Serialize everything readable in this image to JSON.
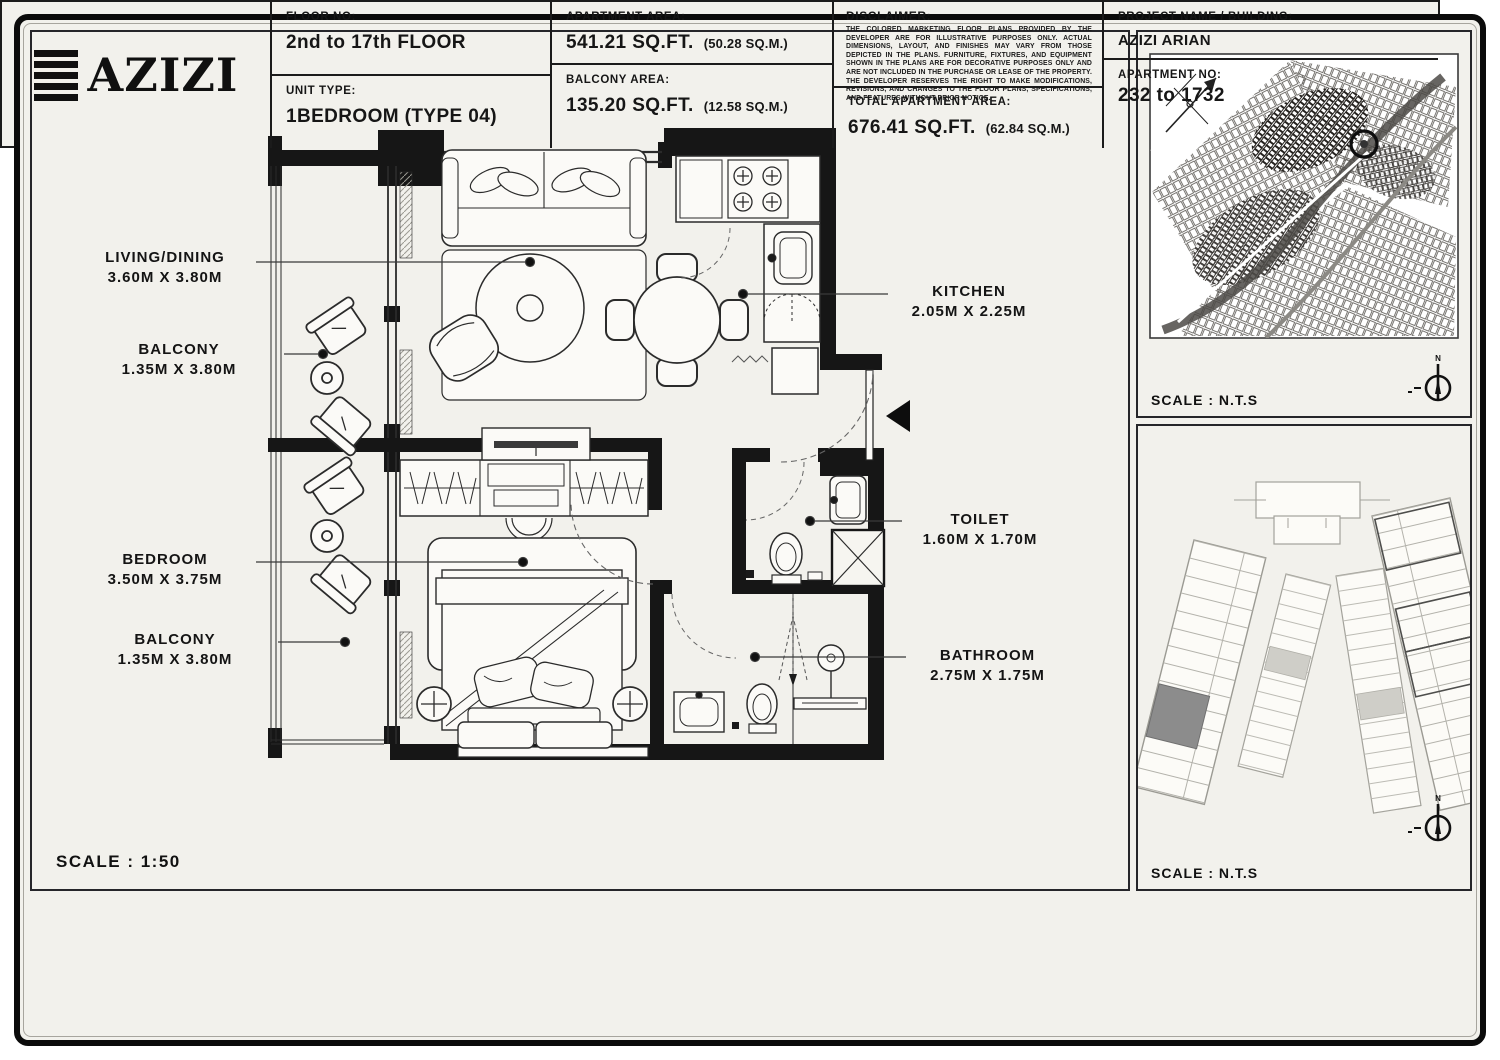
{
  "colors": {
    "paper": "#f2f1ec",
    "line": "#141414",
    "wall": "#161616",
    "furniture_fill": "#fbfaf7",
    "highlight_unit": "#8c8c8c"
  },
  "plan": {
    "scale_label": "SCALE : 1:50",
    "labels": [
      {
        "name": "LIVING/DINING",
        "dims": "3.60M X 3.80M"
      },
      {
        "name": "BALCONY",
        "dims": "1.35M X 3.80M"
      },
      {
        "name": "BEDROOM",
        "dims": "3.50M X 3.75M"
      },
      {
        "name": "BALCONY",
        "dims": "1.35M X 3.80M"
      },
      {
        "name": "KITCHEN",
        "dims": "2.05M X 2.25M"
      },
      {
        "name": "TOILET",
        "dims": "1.60M X 1.70M"
      },
      {
        "name": "BATHROOM",
        "dims": "2.75M X 1.75M"
      }
    ]
  },
  "side_panels": {
    "location_map": {
      "scale_label": "SCALE : N.T.S"
    },
    "key_plan": {
      "scale_label": "SCALE : N.T.S"
    },
    "compass_letter": "N"
  },
  "title_block": {
    "logo_text": "AZIZI",
    "floor": {
      "label": "FLOOR NO:",
      "value": "2nd to 17th FLOOR"
    },
    "unit": {
      "label": "UNIT TYPE:",
      "value": "1BEDROOM (TYPE 04)"
    },
    "apartment_area": {
      "label": "APARTMENT AREA:",
      "value": "541.21 SQ.FT.",
      "metric": "(50.28 SQ.M.)"
    },
    "balcony_area": {
      "label": "BALCONY AREA:",
      "value": "135.20 SQ.FT.",
      "metric": "(12.58 SQ.M.)"
    },
    "disclaimer": {
      "label": "DISCLAIMER:",
      "text": "THE COLORED MARKETING FLOOR PLANS PROVIDED BY THE DEVELOPER ARE FOR ILLUSTRATIVE PURPOSES ONLY. ACTUAL DIMENSIONS, LAYOUT, AND FINISHES MAY VARY FROM THOSE DEPICTED IN THE PLANS. FURNITURE, FIXTURES, AND EQUIPMENT SHOWN IN THE PLANS ARE FOR DECORATIVE PURPOSES ONLY AND ARE NOT INCLUDED IN THE PURCHASE OR LEASE OF THE PROPERTY. THE DEVELOPER RESERVES THE RIGHT TO MAKE MODIFICATIONS, REVISIONS, AND CHANGES TO THE FLOOR PLANS, SPECIFICATIONS, AND FEATURES WITHOUT PRIOR NOTICE."
    },
    "total_area": {
      "label": "TOTAL APARTMENT AREA:",
      "value": "676.41 SQ.FT.",
      "metric": "(62.84 SQ.M.)"
    },
    "project": {
      "label": "PROJECT NAME / BUILDING:",
      "value": "AZIZI ARIAN"
    },
    "apartment_no": {
      "label": "APARTMENT NO:",
      "value": "232 to 1732"
    }
  }
}
